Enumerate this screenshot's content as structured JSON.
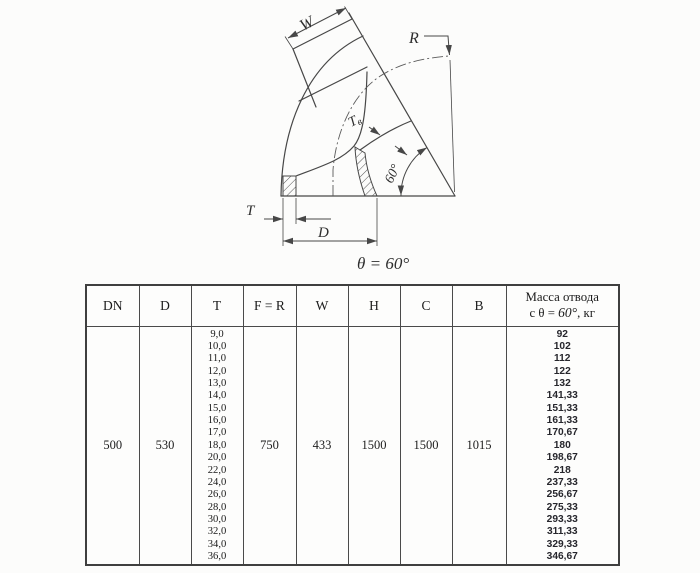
{
  "figure": {
    "caption": "θ = 60°",
    "labels": {
      "w": "W",
      "r": "R",
      "tv_main": "T",
      "tv_sub": "в",
      "angle": "60°",
      "t": "T",
      "d": "D"
    }
  },
  "table": {
    "headers": [
      "DN",
      "D",
      "T",
      "F = R",
      "W",
      "H",
      "C",
      "B"
    ],
    "mass_header": {
      "line1": "Масса отвода",
      "prefix": "с θ = ",
      "value": "60°",
      "suffix": ", кг"
    },
    "row": {
      "dn": "500",
      "d": "530",
      "f_r": "750",
      "w": "433",
      "h": "1500",
      "c": "1500",
      "b": "1015"
    },
    "t_values": [
      "9,0",
      "10,0",
      "11,0",
      "12,0",
      "13,0",
      "14,0",
      "15,0",
      "16,0",
      "17,0",
      "18,0",
      "20,0",
      "22,0",
      "24,0",
      "26,0",
      "28,0",
      "30,0",
      "32,0",
      "34,0",
      "36,0"
    ],
    "mass_values": [
      "92",
      "102",
      "112",
      "122",
      "132",
      "141,33",
      "151,33",
      "161,33",
      "170,67",
      "180",
      "198,67",
      "218",
      "237,33",
      "256,67",
      "275,33",
      "293,33",
      "311,33",
      "329,33",
      "346,67"
    ]
  },
  "colors": {
    "line": "#474747",
    "background": "#fcfcfb",
    "text": "#1d1d1d"
  }
}
